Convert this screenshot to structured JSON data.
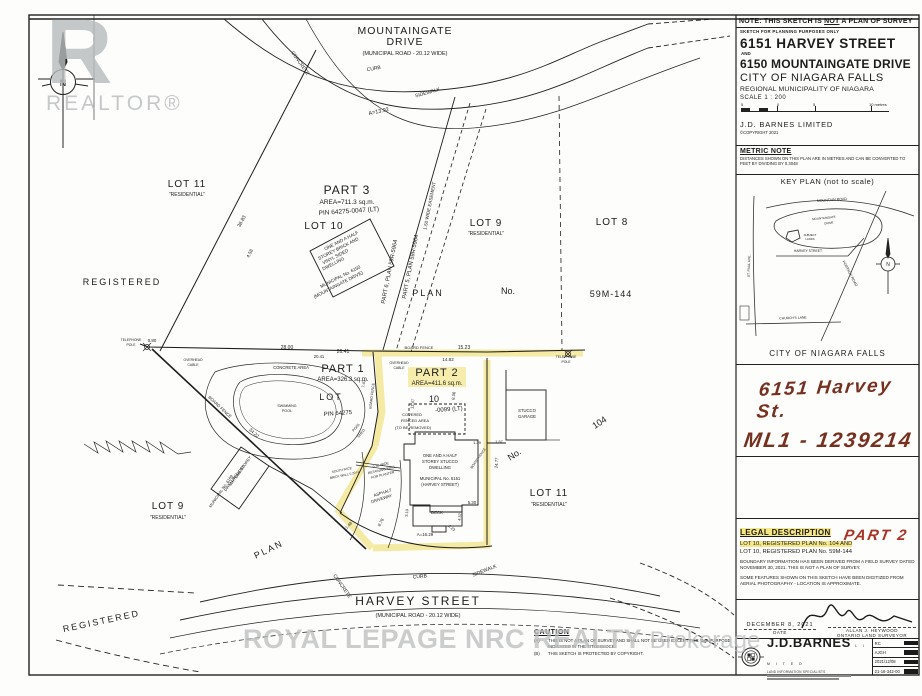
{
  "colors": {
    "highlight": "#f0df6a",
    "ink": "#1c1c1c",
    "hand_ink": "#76301f",
    "hand_red": "#a93226",
    "watermark": "#b9bdbd"
  },
  "title_block": {
    "note_prefix": "NOTE: THIS SKETCH IS ",
    "note_not": "NOT",
    "note_suffix": " A PLAN OF SURVEY",
    "subnote": "SKETCH FOR PLANNING PURPOSES ONLY",
    "address1": "6151 HARVEY STREET",
    "and_label": "AND",
    "address2": "6150 MOUNTAINGATE DRIVE",
    "city": "CITY OF NIAGARA FALLS",
    "region": "REGIONAL MUNICIPALITY OF NIAGARA",
    "scale": "SCALE  1 : 200",
    "tick1": "5",
    "tick2": "0",
    "tick3": "5",
    "tick4": "10 metres",
    "firm": "J.D. BARNES LIMITED",
    "copyright": "©COPYRIGHT 2021"
  },
  "metric_note": {
    "heading": "METRIC NOTE",
    "body": "DISTANCES SHOWN ON THIS PLAN ARE IN METRES AND CAN BE CONVERTED TO FEET BY DIVIDING BY 0.3048"
  },
  "key_plan": {
    "heading": "KEY PLAN (not to scale)",
    "caption": "CITY OF NIAGARA FALLS",
    "labels": [
      {
        "t": "MOUNTAIN ROAD",
        "x": 96,
        "y": 15,
        "s": 3.6,
        "r": -4
      },
      {
        "t": "MOUNTAINGATE",
        "x": 88,
        "y": 33,
        "s": 3,
        "r": -6
      },
      {
        "t": "DRIVE",
        "x": 93,
        "y": 38,
        "s": 3,
        "r": -6
      },
      {
        "t": "SUBJECT",
        "x": 74,
        "y": 50,
        "s": 2.8
      },
      {
        "t": "LANDS",
        "x": 74,
        "y": 54,
        "s": 2.8
      },
      {
        "t": "HARVEY STREET",
        "x": 72,
        "y": 66,
        "s": 3.4
      },
      {
        "t": "PORTAGE ROAD",
        "x": 113,
        "y": 88,
        "s": 3.6,
        "r": 62
      },
      {
        "t": "ST. PAUL AVE.",
        "x": 14,
        "y": 80,
        "s": 3.4,
        "r": -88
      },
      {
        "t": "CHURCH'S LANE",
        "x": 57,
        "y": 133,
        "s": 3.4,
        "r": -2
      },
      {
        "t": "N",
        "x": 152,
        "y": 80,
        "s": 5
      }
    ]
  },
  "annotation_box": {
    "line1": "6151 Harvey St.",
    "line2": "ML1 - 1239214"
  },
  "legal_description": {
    "heading": "LEGAL DESCRIPTION",
    "line1": "LOT 10, REGISTERED PLAN No. 104 AND",
    "part2_annotation": "PART 2",
    "line2": "LOT 10, REGISTERED PLAN No. 59M-144",
    "para1": "BOUNDARY INFORMATION HAS BEEN DERIVED FROM A FIELD SURVEY DATED NOVEMBER 30, 2021.  THIS IS NOT A PLAN OF SURVEY.",
    "para2": "SOME FEATURES SHOWN ON THIS SKETCH HAVE BEEN DIGITIZED FROM AERIAL PHOTOGRAPHY - LOCATION IS APPROXIMATE."
  },
  "signature_block": {
    "date_value": "DECEMBER 8, 2021",
    "date_label": "DATE",
    "surveyor_name": "ALLAN J. HEYWOOD",
    "surveyor_title": "ONTARIO LAND SURVEYOR"
  },
  "footer": {
    "firm": "J.D.BARNES",
    "limited": "L I M I T E D",
    "tagline": "LAND INFORMATION SPECIALISTS",
    "table": {
      "rows": [
        "RC",
        "AJGH",
        "2021/12/08",
        "21-16-342-00"
      ]
    }
  },
  "caution": {
    "heading": "CAUTION",
    "items": [
      {
        "m": "(A)",
        "t": "THIS IS NOT A PLAN OF SURVEY AND SHALL NOT BE USED EXCEPT FOR THE PURPOSE INDICATED IN THE TITLE BLOCK."
      },
      {
        "m": "(B)",
        "t": "THIS SKETCH IS PROTECTED BY COPYRIGHT."
      }
    ]
  },
  "watermarks": {
    "realtor_r": "R",
    "realtor_text": "REALTOR®",
    "brokerage_main": "ROYAL LEPAGE NRC REALTY",
    "brokerage_sub": "Brokerage"
  },
  "plan_labels": [
    {
      "t": "MOUNTAINGATE",
      "x": 405,
      "y": 34,
      "s": 10.5,
      "ls": 1
    },
    {
      "t": "DRIVE",
      "x": 405,
      "y": 45,
      "s": 10.5,
      "ls": 1
    },
    {
      "t": "(MUNICIPAL ROAD - 20.12 WIDE)",
      "x": 405,
      "y": 55,
      "s": 5.5
    },
    {
      "t": "CURB",
      "x": 374,
      "y": 70,
      "s": 5,
      "r": -10
    },
    {
      "t": "SIDEWALK",
      "x": 428,
      "y": 94,
      "s": 5,
      "r": -16
    },
    {
      "t": "CONCRETE",
      "x": 299,
      "y": 64,
      "s": 5,
      "r": 55
    },
    {
      "t": "A=13.92",
      "x": 379,
      "y": 113,
      "s": 5.5,
      "r": -12
    },
    {
      "t": "N",
      "x": 63,
      "y": 86,
      "s": 9
    },
    {
      "t": "LOT 11",
      "x": 187,
      "y": 187,
      "s": 10,
      "ls": 1
    },
    {
      "t": "\"RESIDENTIAL\"",
      "x": 187,
      "y": 196,
      "s": 5
    },
    {
      "t": "REGISTERED",
      "x": 122,
      "y": 285,
      "s": 9,
      "ls": 2
    },
    {
      "t": "PART 3",
      "x": 347,
      "y": 194,
      "s": 12,
      "ls": 1
    },
    {
      "t": "AREA=711.3 sq.m.",
      "x": 347,
      "y": 204,
      "s": 6.5
    },
    {
      "t": "PIN 64275-0047 (LT)",
      "x": 349,
      "y": 213,
      "s": 6.5,
      "r": -4
    },
    {
      "t": "LOT 10",
      "x": 324,
      "y": 229,
      "s": 10,
      "ls": 1
    },
    {
      "t": "ONE AND A HALF",
      "x": 342,
      "y": 242,
      "s": 4.6,
      "r": -27
    },
    {
      "t": "STOREY BRICK AND",
      "x": 339,
      "y": 250,
      "s": 4.6,
      "r": -27
    },
    {
      "t": "VINYL SIDED",
      "x": 336,
      "y": 258,
      "s": 4.6,
      "r": -27
    },
    {
      "t": "DWELLING",
      "x": 334,
      "y": 265,
      "s": 4.6,
      "r": -27
    },
    {
      "t": "MUNICIPAL No. 6150",
      "x": 341,
      "y": 278,
      "s": 4.6,
      "r": -27
    },
    {
      "t": "(MOUNTAINGATE DRIVE)",
      "x": 339,
      "y": 286,
      "s": 4.6,
      "r": -27
    },
    {
      "t": "PART 6, PLAN 59R-5964",
      "x": 391,
      "y": 272,
      "s": 5.8,
      "r": -79
    },
    {
      "t": "PART 5, PLAN 59R-5964",
      "x": 412,
      "y": 267,
      "s": 5.8,
      "r": -79
    },
    {
      "t": "1.50 WIDE EASEMENT",
      "x": 431,
      "y": 206,
      "s": 4.6,
      "r": -79
    },
    {
      "t": "LOT 9",
      "x": 486,
      "y": 226,
      "s": 10,
      "ls": 1
    },
    {
      "t": "\"RESIDENTIAL\"",
      "x": 486,
      "y": 235,
      "s": 5
    },
    {
      "t": "LOT 8",
      "x": 612,
      "y": 225,
      "s": 10,
      "ls": 1
    },
    {
      "t": "PLAN",
      "x": 428,
      "y": 296,
      "s": 9,
      "ls": 2
    },
    {
      "t": "No.",
      "x": 508,
      "y": 294,
      "s": 9
    },
    {
      "t": "59M-144",
      "x": 611,
      "y": 297,
      "s": 9,
      "ls": 1
    },
    {
      "t": "38.83",
      "x": 243,
      "y": 222,
      "s": 5,
      "r": -62
    },
    {
      "t": "4.58",
      "x": 251,
      "y": 254,
      "s": 4.6,
      "r": -62
    },
    {
      "t": "TELEPHONE",
      "x": 131,
      "y": 341,
      "s": 3.4
    },
    {
      "t": "POLE",
      "x": 131,
      "y": 346,
      "s": 3.4
    },
    {
      "t": "0.80",
      "x": 152,
      "y": 342,
      "s": 4.4
    },
    {
      "t": "28.00",
      "x": 287,
      "y": 349,
      "s": 5
    },
    {
      "t": "26.41",
      "x": 343,
      "y": 353,
      "s": 5
    },
    {
      "t": "20.41",
      "x": 319,
      "y": 358,
      "s": 4.2
    },
    {
      "t": "BOARD FENCE",
      "x": 419,
      "y": 349,
      "s": 4
    },
    {
      "t": "15.23",
      "x": 464,
      "y": 349,
      "s": 5
    },
    {
      "t": "14.82",
      "x": 448,
      "y": 361,
      "s": 4.6
    },
    {
      "t": "TELEPHONE",
      "x": 566,
      "y": 358,
      "s": 3.4
    },
    {
      "t": "POLE",
      "x": 566,
      "y": 363,
      "s": 3.4
    },
    {
      "t": "OVERHEAD",
      "x": 193,
      "y": 361,
      "s": 3.4
    },
    {
      "t": "CABLE",
      "x": 193,
      "y": 366,
      "s": 3.4
    },
    {
      "t": "OVERHEAD",
      "x": 399,
      "y": 364,
      "s": 3.4
    },
    {
      "t": "CABLE",
      "x": 399,
      "y": 369,
      "s": 3.4
    },
    {
      "t": "PART 1",
      "x": 343,
      "y": 372,
      "s": 11,
      "ls": 1
    },
    {
      "t": "AREA=326.3 sq.m.",
      "x": 343,
      "y": 381,
      "s": 6
    },
    {
      "t": "PART 2",
      "x": 437,
      "y": 376,
      "s": 11,
      "ls": 1
    },
    {
      "t": "AREA=411.6 sq.m.",
      "x": 437,
      "y": 385,
      "s": 6
    },
    {
      "t": "LOT",
      "x": 331,
      "y": 400,
      "s": 9,
      "ls": 2
    },
    {
      "t": "10",
      "x": 434,
      "y": 402,
      "s": 9
    },
    {
      "t": "PIN 64275",
      "x": 338,
      "y": 415,
      "s": 6,
      "r": -4
    },
    {
      "t": "-0099 (LT)",
      "x": 449,
      "y": 411,
      "s": 6,
      "r": -4
    },
    {
      "t": "CONCRETE AREA",
      "x": 291,
      "y": 369,
      "s": 4.2
    },
    {
      "t": "SWIMMING",
      "x": 287,
      "y": 407,
      "s": 3.6
    },
    {
      "t": "POOL",
      "x": 287,
      "y": 412,
      "s": 3.6
    },
    {
      "t": "BOARD FENCE",
      "x": 219,
      "y": 408,
      "s": 4.2,
      "r": 43
    },
    {
      "t": "34.22",
      "x": 253,
      "y": 434,
      "s": 4.6,
      "r": 43
    },
    {
      "t": "BOARD FENCE",
      "x": 373,
      "y": 396,
      "s": 3.6,
      "r": -83
    },
    {
      "t": "7.43",
      "x": 365,
      "y": 384,
      "s": 4.2,
      "r": -83
    },
    {
      "t": "11.47",
      "x": 414,
      "y": 404,
      "s": 4.2,
      "r": -83
    },
    {
      "t": "8.36",
      "x": 455,
      "y": 396,
      "s": 4.2,
      "r": -83
    },
    {
      "t": "POOL",
      "x": 357,
      "y": 428,
      "s": 3.6,
      "r": -50
    },
    {
      "t": "SHED",
      "x": 362,
      "y": 434,
      "s": 3.6,
      "r": -50
    },
    {
      "t": "COVERED",
      "x": 412,
      "y": 416,
      "s": 4
    },
    {
      "t": "FENCED AREA",
      "x": 415,
      "y": 422,
      "s": 4
    },
    {
      "t": "(TO BE REMOVED)",
      "x": 413,
      "y": 429,
      "s": 4
    },
    {
      "t": "STUCCO",
      "x": 527,
      "y": 412,
      "s": 4.2
    },
    {
      "t": "GARAGE",
      "x": 527,
      "y": 418,
      "s": 4.2
    },
    {
      "t": "104",
      "x": 601,
      "y": 425,
      "s": 9,
      "r": -33
    },
    {
      "t": "No.",
      "x": 516,
      "y": 457,
      "s": 9,
      "r": -33
    },
    {
      "t": "BOARD FENCE",
      "x": 479,
      "y": 459,
      "s": 3.4,
      "r": -55
    },
    {
      "t": "1.39",
      "x": 477,
      "y": 444,
      "s": 4
    },
    {
      "t": "1.57",
      "x": 499,
      "y": 443,
      "s": 3.8
    },
    {
      "t": "24.77",
      "x": 498,
      "y": 463,
      "s": 4.2,
      "r": -85
    },
    {
      "t": "ONE AND A HALF",
      "x": 440,
      "y": 457,
      "s": 4.2
    },
    {
      "t": "STOREY STUCCO",
      "x": 440,
      "y": 463,
      "s": 4.2
    },
    {
      "t": "DWELLING",
      "x": 440,
      "y": 469,
      "s": 4.2
    },
    {
      "t": "MUNICIPAL No. 6151",
      "x": 440,
      "y": 480,
      "s": 4.2
    },
    {
      "t": "(HARVEY STREET)",
      "x": 440,
      "y": 486,
      "s": 4.2
    },
    {
      "t": "DECK",
      "x": 437,
      "y": 514,
      "s": 4.2
    },
    {
      "t": "5.30",
      "x": 472,
      "y": 504,
      "s": 4.2
    },
    {
      "t": "3.10",
      "x": 408,
      "y": 513,
      "s": 3.8,
      "r": -85
    },
    {
      "t": "4.57",
      "x": 461,
      "y": 517,
      "s": 3.8,
      "r": -85
    },
    {
      "t": "2.23",
      "x": 451,
      "y": 529,
      "s": 3.8,
      "r": 40
    },
    {
      "t": "A=16.29",
      "x": 425,
      "y": 536,
      "s": 4.4
    },
    {
      "t": "8.76",
      "x": 382,
      "y": 523,
      "s": 4.2,
      "r": -62
    },
    {
      "t": "11.48",
      "x": 349,
      "y": 527,
      "s": 4.2,
      "r": -48
    },
    {
      "t": "SOUTH FACE",
      "x": 342,
      "y": 471,
      "s": 3.2,
      "r": -12
    },
    {
      "t": "BRICK WALL 0.20 N.",
      "x": 345,
      "y": 476,
      "s": 3.2,
      "r": -12
    },
    {
      "t": "0.30 WIDE",
      "x": 381,
      "y": 466,
      "s": 3.4,
      "r": -14
    },
    {
      "t": "RETAINING WALL",
      "x": 382,
      "y": 471,
      "s": 3.4,
      "r": -14
    },
    {
      "t": "FOR PLANTER",
      "x": 383,
      "y": 476,
      "s": 3.4,
      "r": -14
    },
    {
      "t": "ASPHALT",
      "x": 383,
      "y": 494,
      "s": 4.2,
      "r": -18
    },
    {
      "t": "DRIVEWAY",
      "x": 382,
      "y": 500,
      "s": 4.2,
      "r": -18
    },
    {
      "t": "LOT 11",
      "x": 549,
      "y": 496,
      "s": 10,
      "ls": 1
    },
    {
      "t": "\"RESIDENTIAL\"",
      "x": 549,
      "y": 506,
      "s": 5
    },
    {
      "t": "LOT 9",
      "x": 168,
      "y": 509,
      "s": 10,
      "ls": 1
    },
    {
      "t": "\"RESIDENTIAL\"",
      "x": 168,
      "y": 519,
      "s": 5
    },
    {
      "t": "ONE STOREY",
      "x": 244,
      "y": 468,
      "s": 4,
      "r": -55
    },
    {
      "t": "VINYL SIDED",
      "x": 238,
      "y": 476,
      "s": 4,
      "r": -55
    },
    {
      "t": "DWELLING",
      "x": 232,
      "y": 483,
      "s": 4,
      "r": -55
    },
    {
      "t": "MUNICIPAL No. 6169",
      "x": 222,
      "y": 492,
      "s": 4,
      "r": -55
    },
    {
      "t": "PLAN",
      "x": 270,
      "y": 552,
      "s": 9,
      "r": -26,
      "ls": 2
    },
    {
      "t": "REGISTERED",
      "x": 102,
      "y": 624,
      "s": 9,
      "r": -12,
      "ls": 2
    },
    {
      "t": "HARVEY STREET",
      "x": 418,
      "y": 605,
      "s": 12,
      "ls": 2
    },
    {
      "t": "(MUNICIPAL ROAD - 20.12 WIDE)",
      "x": 418,
      "y": 617,
      "s": 5.5
    },
    {
      "t": "CONCRETE",
      "x": 341,
      "y": 587,
      "s": 5,
      "r": 55
    },
    {
      "t": "CURB",
      "x": 420,
      "y": 578,
      "s": 5,
      "r": -5
    },
    {
      "t": "SIDEWALK",
      "x": 485,
      "y": 572,
      "s": 5,
      "r": -22
    }
  ]
}
